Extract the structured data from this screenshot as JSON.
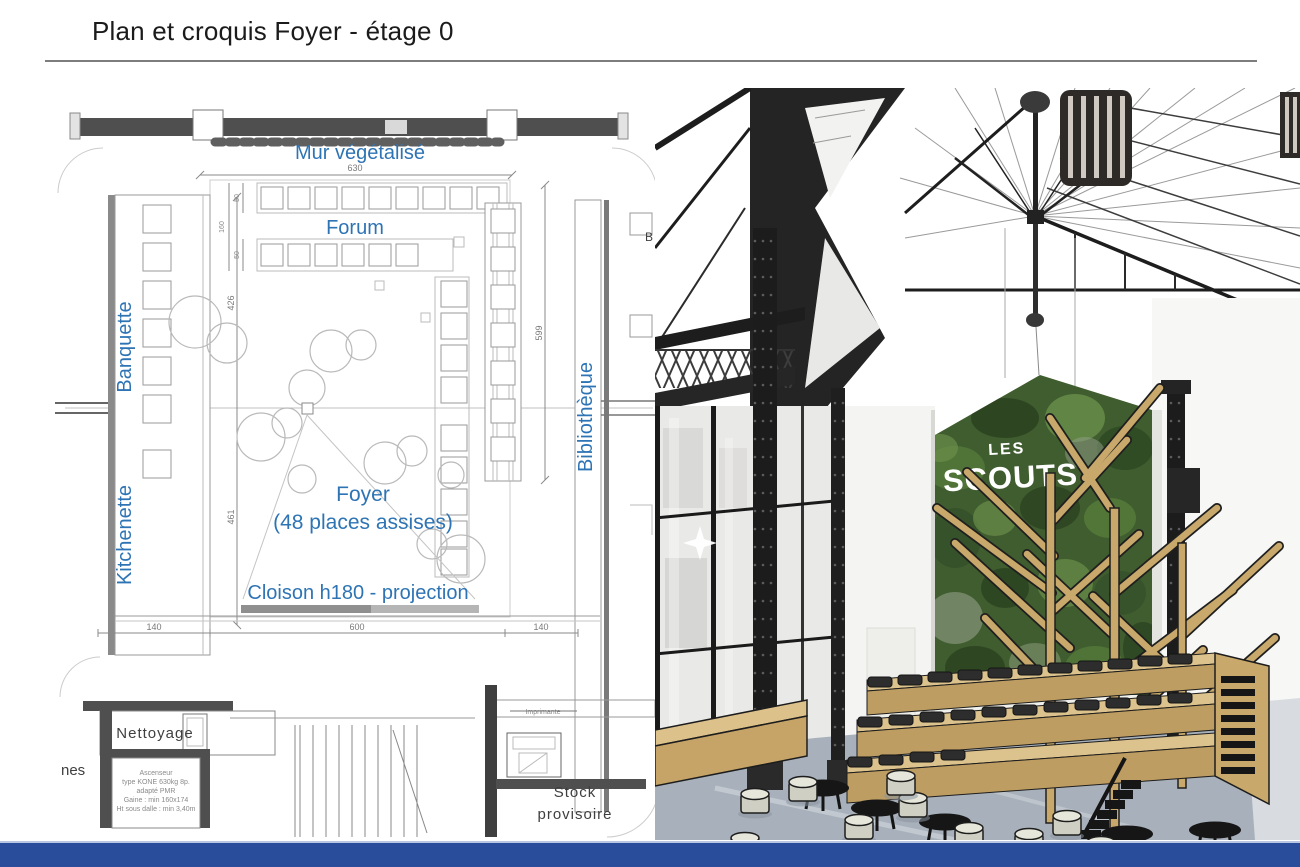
{
  "slide": {
    "title": "Plan et croquis Foyer - étage 0"
  },
  "plan": {
    "label_color": "#2E74B5",
    "labels": {
      "mur": "Mur végétalisé",
      "forum": "Forum",
      "banquette": "Banquette",
      "kitchenette": "Kitchenette",
      "bibliotheque": "Bibliothèque",
      "foyer": "Foyer",
      "capacity": "(48 places assises)",
      "cloison": "Cloison h180 - projection",
      "nettoyage": "Nettoyage",
      "imprimante": "Imprimante",
      "stock_line1": "Stock",
      "stock_line2": "provisoire",
      "room_b": "B",
      "edge_fragment": "nes"
    },
    "dims": {
      "top": "630",
      "left_upper": "426",
      "left_lower": "461",
      "right": "599",
      "bottom_left": "140",
      "bottom_center": "600",
      "bottom_right": "140",
      "row_depth": "160",
      "seat_a": "50",
      "seat_b": "50"
    },
    "elevator_note": [
      "Ascenseur",
      "type KONE 630kg 8p.",
      "adapté PMR",
      "Gaine : min 160x174",
      "Ht sous dalle : min 3,40m"
    ]
  },
  "render": {
    "logo": {
      "line1": "LES",
      "line2": "SCOUTS"
    },
    "colors": {
      "wood": "#C8A86B",
      "green_wall": "#405D2F",
      "floor": "#A8B1BB",
      "iron": "#1D1D1D"
    }
  },
  "footer": {
    "color": "#2A4D9B"
  }
}
